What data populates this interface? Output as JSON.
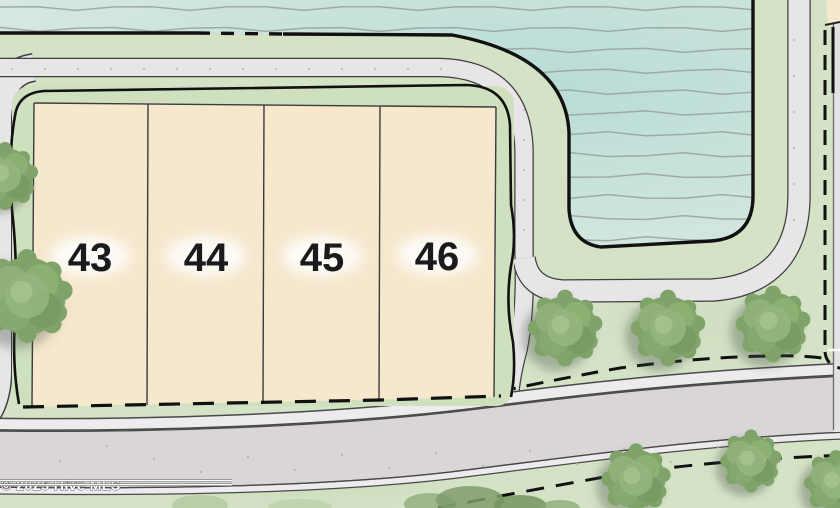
{
  "map": {
    "type": "residential lot site plan",
    "lots": [
      {
        "number": "43"
      },
      {
        "number": "44"
      },
      {
        "number": "45"
      },
      {
        "number": "46"
      }
    ],
    "tree_count": 8,
    "watermark": "© 2025 Hive MLS",
    "colors": {
      "land": "#d4e2c6",
      "block_green": "#cfe0bf",
      "water_center": "#b9dcd6",
      "water_edge": "#dcebe3",
      "ripple": "#9ba59e",
      "lot_fill": "#f5e8cd",
      "lot_line": "#3c3c3c",
      "road_fill": "#e8e5e8",
      "road_casing": "#3f3f3f",
      "main_road_fill": "#d9d5d9",
      "sidewalk_fill": "#edebed",
      "boundary": "#111111",
      "tree": "#7fa369"
    }
  }
}
